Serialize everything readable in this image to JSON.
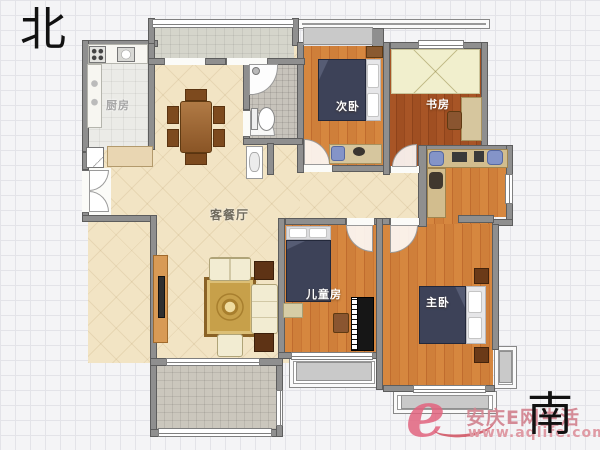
{
  "compass": {
    "north": "北",
    "south": "南"
  },
  "rooms": {
    "kitchen": {
      "label": "厨房"
    },
    "living_dining": {
      "label": "客餐厅"
    },
    "secondary_bedroom": {
      "label": "次卧"
    },
    "study": {
      "label": "书房"
    },
    "children_room": {
      "label": "儿童房"
    },
    "master_bedroom": {
      "label": "主卧"
    }
  },
  "watermark": {
    "logo_letter": "e",
    "site_name": "安庆E网生活",
    "site_url": "www.aqlife.com",
    "pink": "#e0607c"
  },
  "palette": {
    "wall": "#8f8f8f",
    "wood_floor": "#d0813d",
    "study_floor": "#9e4e22",
    "tile_floor": "#f2e4c4",
    "bedding_navy": "#3d4258"
  }
}
